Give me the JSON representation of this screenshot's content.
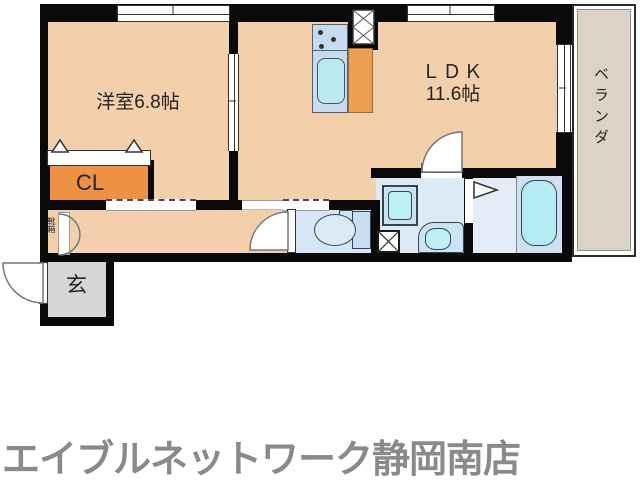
{
  "floorplan": {
    "rooms": {
      "western_room": {
        "label": "洋室6.8帖"
      },
      "ldk": {
        "name": "ＬＤＫ",
        "size": "11.6帖"
      },
      "veranda": {
        "label": "ベランダ"
      },
      "closet": {
        "label": "CL"
      },
      "entrance": {
        "label": "玄"
      },
      "shoe_box": {
        "label": "靴箱"
      }
    },
    "fixtures": [
      "kitchen-counter",
      "stove-burners",
      "kitchen-sink",
      "refrigerator-space",
      "pipe-space-hatch",
      "toilet",
      "washbasin",
      "washing-machine-pan",
      "vanity-basin",
      "bathtub"
    ],
    "colors": {
      "room_floor": "#f4cfab",
      "closet_orange": "#ef9143",
      "wet_area_blue": "#dceaf6",
      "fixture_cyan": "#b4ebf4",
      "entrance_gray": "#d6d6d6",
      "veranda_beige": "#dcd3c7",
      "wall": "#0a0a0a"
    }
  },
  "footer": {
    "store_name": "エイブルネットワーク静岡南店",
    "color": "#8a8a8a"
  }
}
